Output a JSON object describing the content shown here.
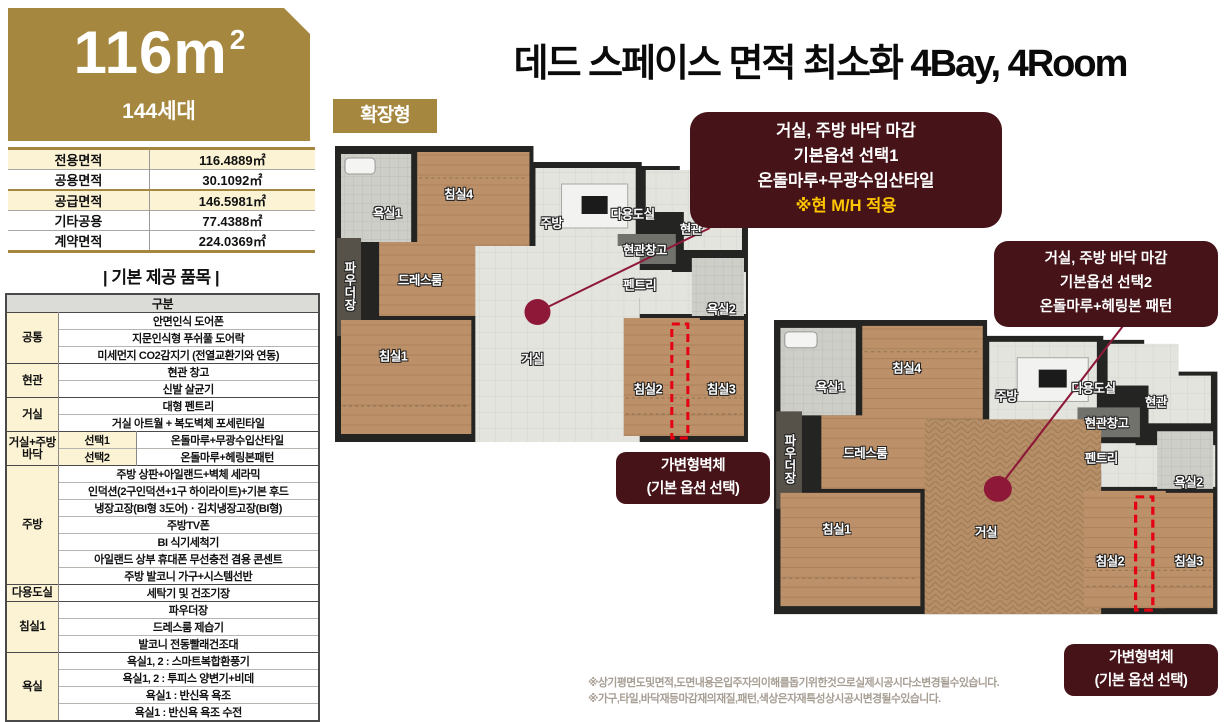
{
  "left_panel": {
    "banner": {
      "size_main": "116m",
      "size_sup": "2",
      "households": "144세대"
    },
    "area_table": {
      "rows": [
        {
          "label": "전용면적",
          "value": "116.4889㎡"
        },
        {
          "label": "공용면적",
          "value": "30.1092㎡"
        },
        {
          "label": "공급면적",
          "value": "146.5981㎡"
        },
        {
          "label": "기타공용",
          "value": "77.4388㎡"
        },
        {
          "label": "계약면적",
          "value": "224.0369㎡"
        }
      ]
    },
    "items": {
      "title": "| 기본 제공 품목 |",
      "header": "구분",
      "groups": [
        {
          "label": "공통",
          "items": [
            "안면인식 도어폰",
            "지문인식형 푸쉬풀 도어락",
            "미세먼지 CO2감지기 (전열교환기와 연동)"
          ]
        },
        {
          "label": "현관",
          "items": [
            "현관 창고",
            "신발 살균기"
          ]
        },
        {
          "label": "거실",
          "items": [
            "대형 펜트리",
            "거실 아트월 + 복도벽체 포세린타일"
          ]
        },
        {
          "label": "거실+주방바닥",
          "options": [
            {
              "name": "선택1",
              "value": "온돌마루+무광수입산타일"
            },
            {
              "name": "선택2",
              "value": "온돌마루+헤링본패턴"
            }
          ]
        },
        {
          "label": "주방",
          "items": [
            "주방 상판+아일랜드+벽체 세라믹",
            "인덕션(2구인덕션+1구 하이라이트)+기본 후드",
            "냉장고장(BI형 3도어)ㆍ김치냉장고장(BI형)",
            "주방TV폰",
            "BI 식기세척기",
            "아일랜드 상부 휴대폰 무선충전 겸용 콘센트",
            "주방 발코니 가구+시스템선반"
          ]
        },
        {
          "label": "다용도실",
          "items": [
            "세탁기 및 건조기장"
          ]
        },
        {
          "label": "침실1",
          "items": [
            "파우더장",
            "드레스룸 제습기",
            "발코니 전동빨래건조대"
          ]
        },
        {
          "label": "욕실",
          "items": [
            "욕실1, 2 : 스마트복합환풍기",
            "욕실1, 2 : 투피스 양변기+비데",
            "욕실1 : 반신욕 욕조",
            "욕실1 : 반신욕 욕조 수전"
          ]
        }
      ]
    }
  },
  "main": {
    "title": "데드 스페이스 면적 최소화 4Bay, 4Room",
    "badge": "확장형",
    "callouts": [
      {
        "line1": "거실, 주방 바닥 마감",
        "line2": "기본옵션 선택1",
        "line3": "온돌마루+무광수입산타일",
        "highlight": "※현 M/H 적용"
      },
      {
        "line1": "거실, 주방 바닥 마감",
        "line2": "기본옵션 선택2",
        "line3": "온돌마루+헤링본 패턴"
      }
    ],
    "wall_label": {
      "line1": "가변형벽체",
      "line2": "(기본 옵션 선택)"
    },
    "rooms": {
      "bath1": "욕실1",
      "bed4": "침실4",
      "kitchen": "주방",
      "utility": "다용도실",
      "entrance": "현관",
      "entrance_storage": "현관창고",
      "pantry": "펜트리",
      "powder": "파우더장",
      "dressroom": "드레스룸",
      "bed1": "침실1",
      "living": "거실",
      "bed2": "침실2",
      "bed3": "침실3",
      "bath2": "욕실2"
    },
    "notes": [
      "※상기평면도및면적,도면내용은입주자의이해를돕기위한것으로실제시공시다소변경될수있습니다.",
      "※가구,타일,바닥재등마감재의재질,패턴,색상은자재특성상시공시변경될수있습니다."
    ]
  },
  "colors": {
    "gold": "#A5873F",
    "maroon": "#451318",
    "crimson": "#8E1838",
    "cream": "#FBF3D4",
    "highlight_yellow": "#FFC600",
    "dash_red": "#E60012"
  }
}
